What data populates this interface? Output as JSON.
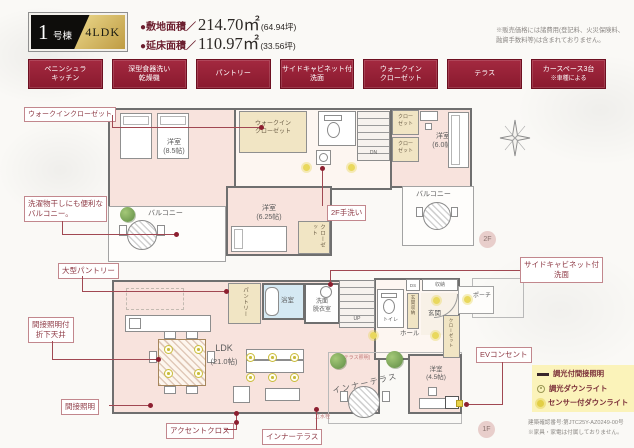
{
  "header": {
    "badge": {
      "number": "1",
      "suffix": "号棟",
      "type": "4LDK"
    },
    "areas": [
      {
        "label": "●敷地面積／",
        "value": "214.70㎡",
        "tsubo": "(64.94坪)"
      },
      {
        "label": "●延床面積／",
        "value": "110.97㎡",
        "tsubo": "(33.56坪)"
      }
    ],
    "disclaimer1": "※販売価格には諸費用(登記料、火災保険料、",
    "disclaimer2": "融資手数料等)は含まれておりません。"
  },
  "features": [
    {
      "line1": "ペニンシュラ",
      "line2": "キッチン"
    },
    {
      "line1": "深型食器洗い",
      "line2": "乾燥機"
    },
    {
      "line1": "パントリー",
      "line2": ""
    },
    {
      "line1": "サイドキャビネット付",
      "line2": "洗面"
    },
    {
      "line1": "ウォークイン",
      "line2": "クローゼット"
    },
    {
      "line1": "テラス",
      "line2": ""
    },
    {
      "line1": "カースペース3台",
      "line2": "※車種による"
    }
  ],
  "callouts": {
    "wic": "ウォークインクローゼット",
    "balcony1": "洗濯物干しにも便利な",
    "balcony2": "バルコニー。",
    "pantry": "大型パントリー",
    "ceiling1": "間接照明付",
    "ceiling2": "折下天井",
    "indirect": "間接照明",
    "accent": "アクセントクロス",
    "inner_terrace": "インナーテラス",
    "side_cabinet1": "サイドキャビネット付",
    "side_cabinet2": "洗面",
    "tearai": "2F手洗い",
    "ev": "EVコンセント"
  },
  "floor2": {
    "badge": "2F",
    "room85_1": "洋室",
    "room85_2": "(8.5帖)",
    "wic1": "ウォークイン",
    "wic2": "クローゼット",
    "closet_a1": "クロー",
    "closet_a2": "ゼット",
    "closet_b1": "クロー",
    "closet_b2": "ゼット",
    "room60_1": "洋室",
    "room60_2": "(6.0帖)",
    "room625_1": "洋室",
    "room625_2": "(6.25帖)",
    "closet_c": "クローゼット",
    "balcony_left": "バルコニー",
    "balcony_right": "バルコニー",
    "dn": "DN"
  },
  "floor1": {
    "badge": "1F",
    "ldk1": "LDK",
    "ldk2": "(21.0帖)",
    "pantry": "パントリー",
    "bath": "浴室",
    "washroom1": "洗面",
    "washroom2": "脱衣室",
    "up": "UP",
    "toilet": "トイレ",
    "ds": "DS",
    "storage": "収納",
    "entrance_storage": "玄関収納",
    "entrance": "玄関",
    "porch": "ポーチ",
    "hall": "ホール",
    "closet": "クローゼット",
    "room45_1": "洋室",
    "room45_2": "(4.5帖)",
    "terrace_light": "(テラス照明)",
    "faucet": "立水栓",
    "inner_terrace": "インナーテラス"
  },
  "legend": {
    "items": [
      {
        "label": "調光付間接照明"
      },
      {
        "label": "調光ダウンライト"
      },
      {
        "label": "センサー付ダウンライト"
      }
    ]
  },
  "notes": {
    "line1": "建築確認番号:第JTC25Y-AZ0249-00号",
    "line2": "※家具・家電は付属しておりません。"
  }
}
